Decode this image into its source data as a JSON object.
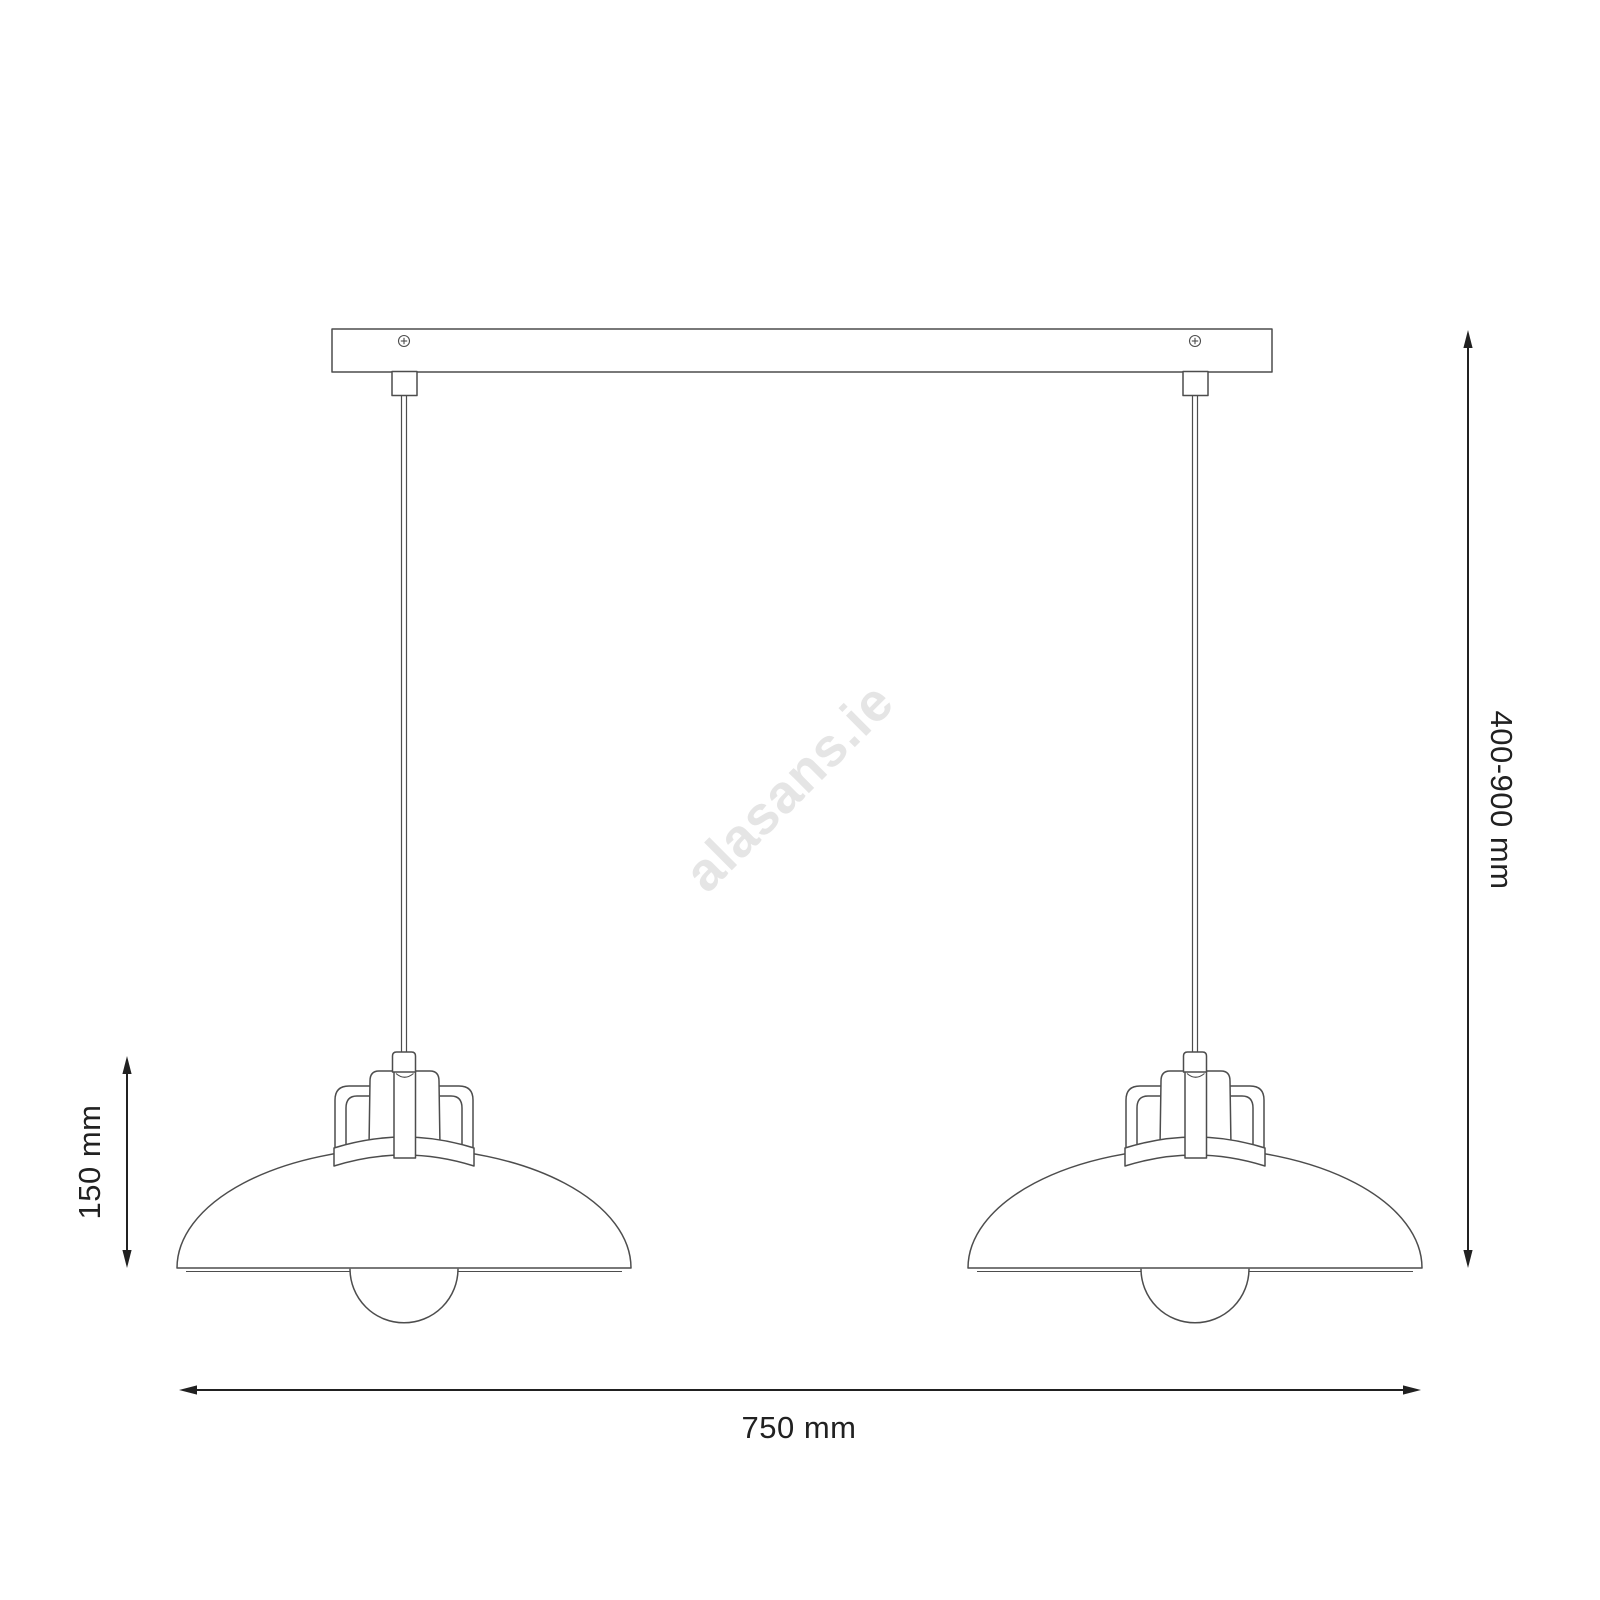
{
  "dimensions": {
    "height_range": "400-900 mm",
    "shade_height": "150 mm",
    "width": "750 mm"
  },
  "watermark": "alasans.ie",
  "colors": {
    "background": "#ffffff",
    "line": "#4d4d4d",
    "dimension": "#212121",
    "watermark": "#e5e5e5"
  }
}
